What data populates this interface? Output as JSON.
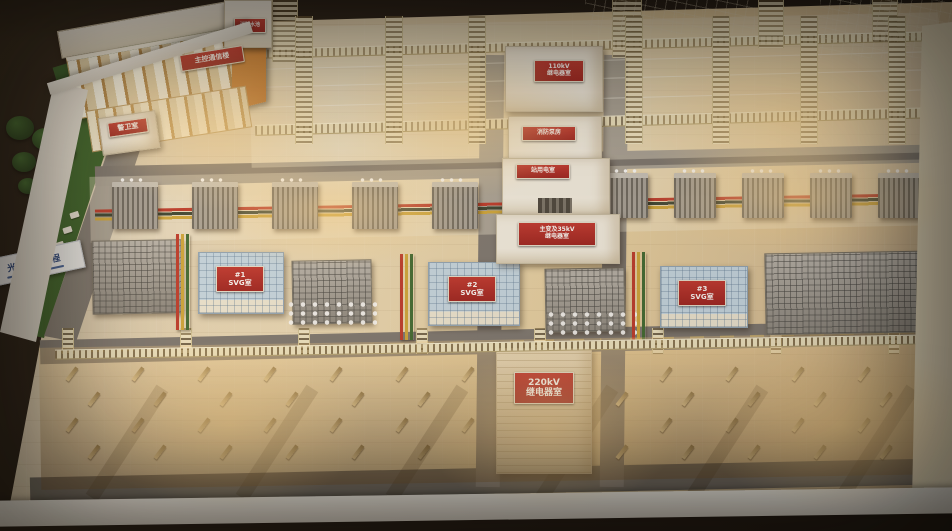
{
  "scene": {
    "description": "Photograph of an illuminated physical scale model (sand table) of a photovoltaic-project booster substation on a white display table",
    "plaque_label": "光伏配套工程"
  },
  "signs": {
    "main_building": "主控通信楼",
    "guard_room": "警卫室",
    "roof_structure": "消防水池",
    "north_relay_room": [
      "110kV",
      "继电器室"
    ],
    "fire_pump_room": "消防泵房",
    "station_power_room": "站用电室",
    "transformer_relay_room": [
      "主变及35kV",
      "继电器室"
    ],
    "svg_room_1": [
      "#1",
      "SVG室"
    ],
    "svg_room_2": [
      "#2",
      "SVG室"
    ],
    "svg_room_3": [
      "#3",
      "SVG室"
    ],
    "relay_room_220kv": [
      "220kV",
      "继电器室"
    ]
  },
  "colors": {
    "sign_red": "#b02a26",
    "sign_text": "#ffffff",
    "busbar_red": "#c03a2c",
    "busbar_yellow": "#d2a93c",
    "busbar_green": "#3f6b33",
    "grass_green": "#35602a",
    "truss_cream": "#f3e9c6",
    "warm_glow": "#ffd68c",
    "table_frame": "#f0ede6"
  },
  "model_features": {
    "top_yard_tower_count": 7,
    "transformer_count_left": 5,
    "transformer_count_right": 5,
    "svg_room_count": 3,
    "bottom_gantry_tower_count": 8,
    "bottom_equipment_rows": 4,
    "bottom_equipment_cols": 13,
    "tree_count": 6,
    "fence_post_count": 7,
    "shadow_stripe_count": 6
  }
}
